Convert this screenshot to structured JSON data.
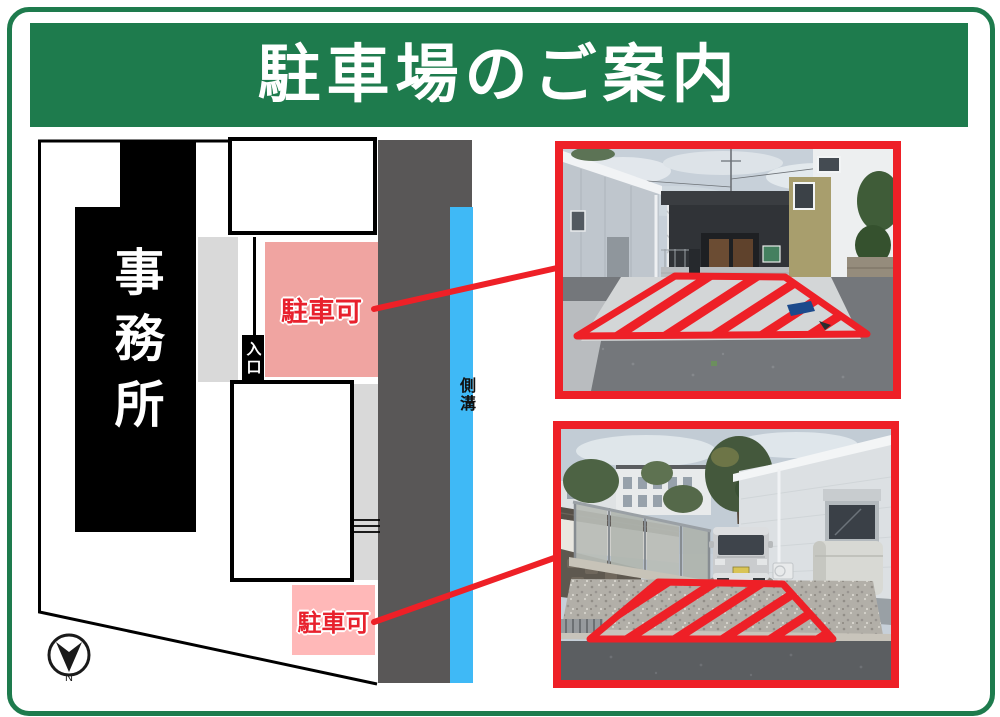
{
  "header": {
    "title": "駐車場のご案内"
  },
  "map": {
    "office_label": "事務所",
    "entrance_label": "入口",
    "gutter_label": "側溝",
    "top_parking_label": "駐車可",
    "bottom_parking_label": "駐車可",
    "compass_north_label": "N",
    "colors": {
      "road_gray": "#595757",
      "gutter_blue": "#3fb9f6",
      "top_parking_pink": "#f0a4a1",
      "bottom_parking_pink": "#ffb8b8",
      "walkway_gray": "#d9d9d9",
      "building_black": "#000000",
      "parking_text_red": "#e8212d"
    }
  },
  "accents": {
    "frame_green": "#1e7b4d",
    "callout_red": "#ee2027"
  }
}
